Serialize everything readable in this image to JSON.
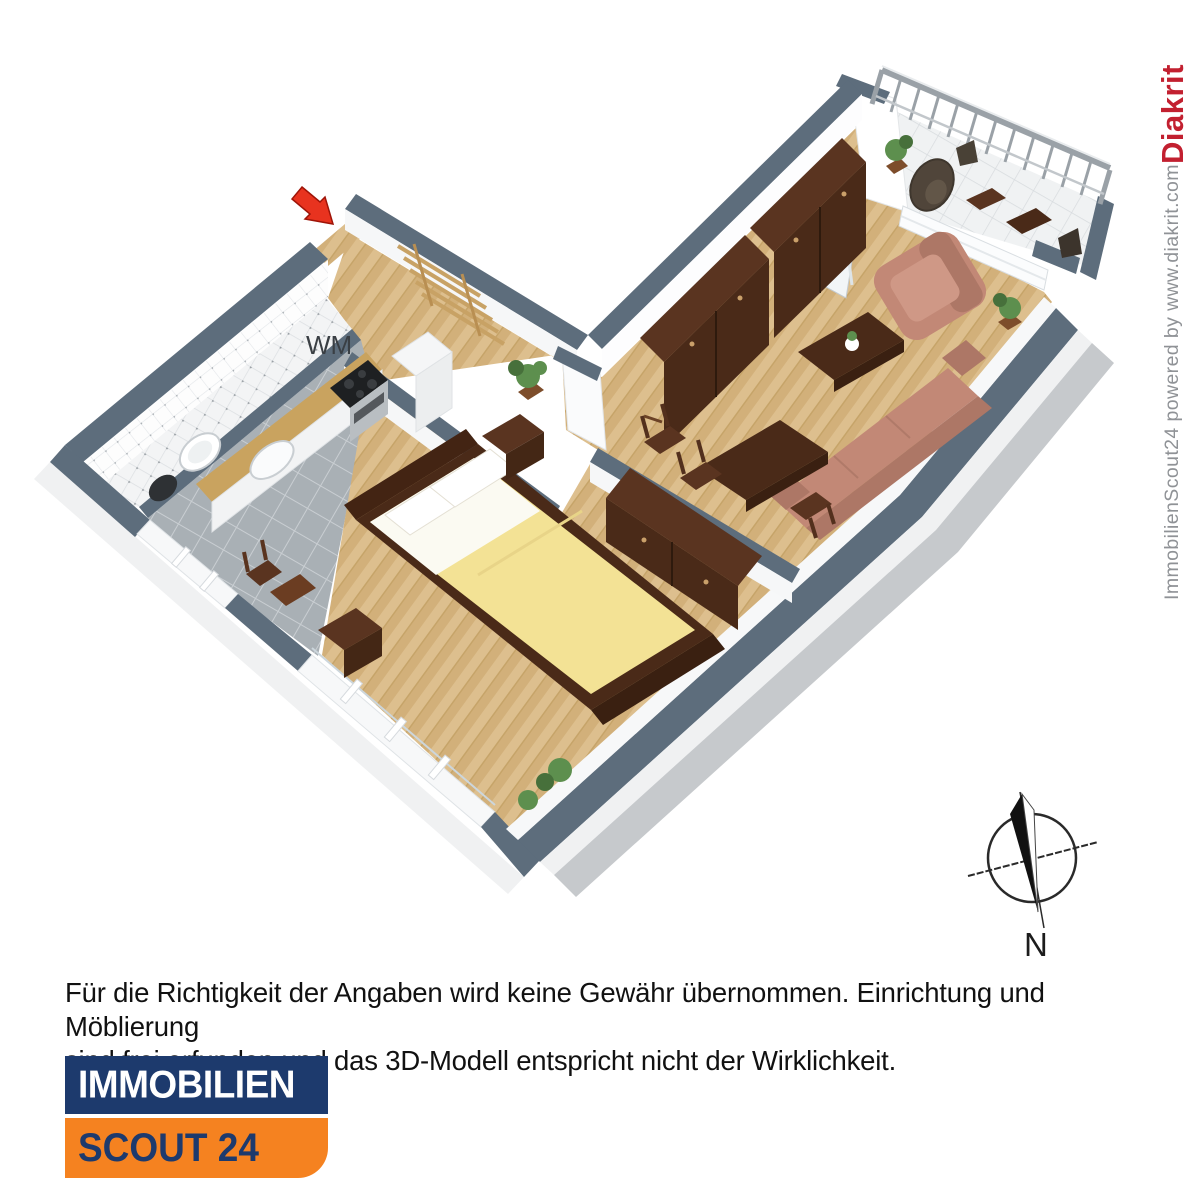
{
  "floorplan": {
    "labels": {
      "washing_machine": "WM"
    },
    "scene": {
      "rooms": [
        "hallway",
        "bathroom",
        "kitchen",
        "bedroom",
        "living-room",
        "balcony"
      ],
      "furniture": [
        "coat-rack",
        "wash-basin",
        "toilet",
        "kitchen-counter",
        "sink",
        "stove-oven",
        "tall-cabinet",
        "kitchen-chair",
        "double-bed",
        "nightstand",
        "dresser",
        "wardrobe",
        "dining-table",
        "dining-chairs",
        "coffee-table",
        "sofa",
        "armchair",
        "balcony-chairs",
        "balcony-tables",
        "plants"
      ],
      "entrance_marker": "red-arrow"
    }
  },
  "compass": {
    "north_label": "N"
  },
  "attribution": {
    "powered_text": "ImmobilienScout24 powered by www.diakrit.com ",
    "brand": "Diakrit"
  },
  "disclaimer": {
    "line1": "Für die Richtigkeit der Angaben wird keine Gewähr übernommen. Einrichtung und Möblierung",
    "line2": "sind frei erfunden und das 3D-Modell entspricht nicht der Wirklichkeit."
  },
  "logo": {
    "top_text": "IMMOBILIEN",
    "bottom_text": "SCOUT 24"
  },
  "colors": {
    "wall_top": "#5d6d7c",
    "wall_face": "#ffffff",
    "skirt": "#c6c9cc",
    "skirt_light": "#f0f1f2",
    "wood": "#ddbf8e",
    "wood_stripe": "#d2b07a",
    "wood_line": "#c6a469",
    "tile_kitchen": "#a9b0b5",
    "tile_grout": "#c9ced2",
    "furniture_dark": "#4a2a18",
    "furniture_mid": "#5a3420",
    "furniture_deep": "#3a2011",
    "counter_wood": "#c9a35f",
    "sofa": "#c28876",
    "sofa_dark": "#ad7766",
    "bed_yellow": "#f3e295",
    "steel": "#b9bec2",
    "cooktop": "#1e2022",
    "plant": "#5d8f4e",
    "plant_dark": "#47703b",
    "pot": "#7d4d2b",
    "arrow_red": "#e8331f",
    "navy": "#1d3a6d",
    "orange": "#f58220",
    "diakrit_red": "#c22030",
    "attrib_gray": "#8f9296",
    "ink": "#111111"
  }
}
